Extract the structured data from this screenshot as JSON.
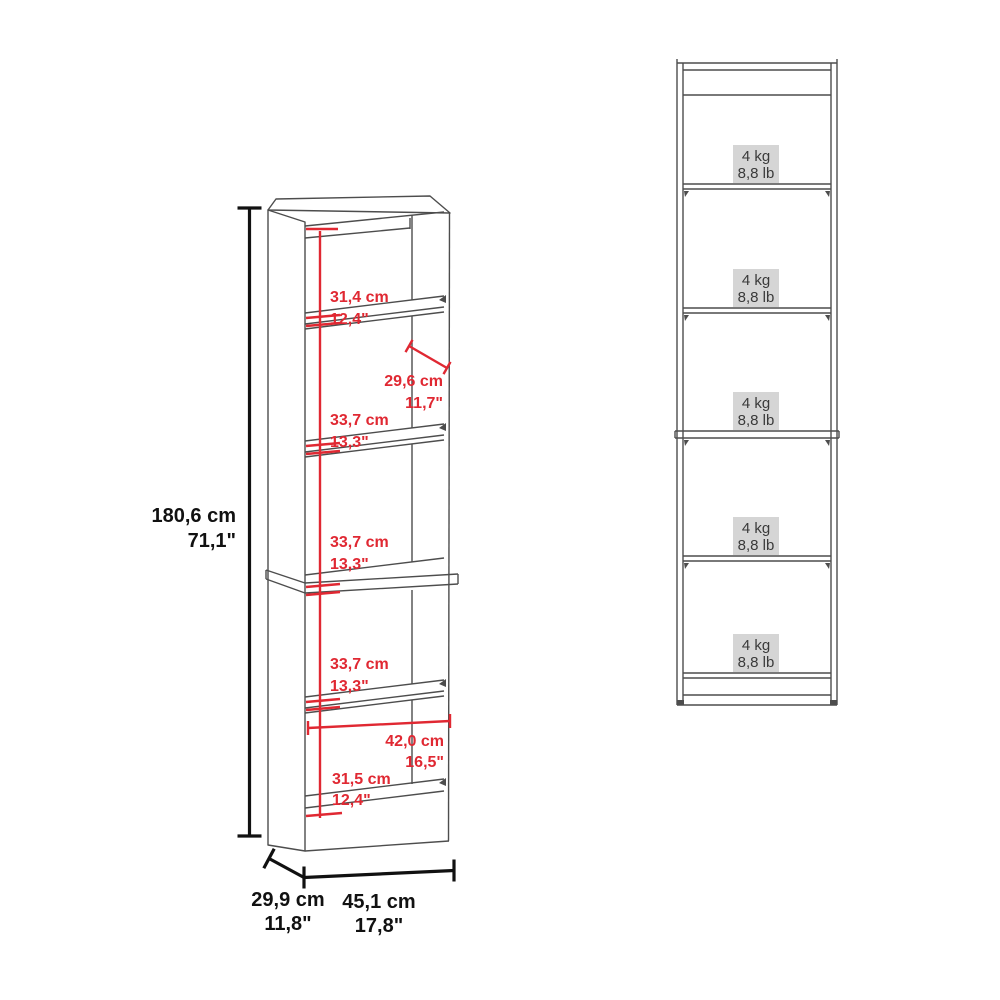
{
  "diagram": {
    "perspective_view": {
      "overall_height_cm": "180,6 cm",
      "overall_height_in": "71,1\"",
      "overall_depth_cm": "29,9 cm",
      "overall_depth_in": "11,8\"",
      "overall_width_cm": "45,1 cm",
      "overall_width_in": "17,8\"",
      "sections": [
        {
          "cm": "31,4 cm",
          "in": "12,4\""
        },
        {
          "cm": "29,6 cm",
          "in": "11,7\""
        },
        {
          "cm": "33,7 cm",
          "in": "13,3\""
        },
        {
          "cm": "33,7 cm",
          "in": "13,3\""
        },
        {
          "cm": "33,7 cm",
          "in": "13,3\""
        },
        {
          "cm": "42,0 cm",
          "in": "16,5\""
        },
        {
          "cm": "31,5 cm",
          "in": "12,4\""
        }
      ]
    },
    "front_view": {
      "shelf_count": 5,
      "shelf_capacity_kg": "4 kg",
      "shelf_capacity_lb": "8,8 lb"
    },
    "colors": {
      "dimension_red": "#e02832",
      "dimension_black": "#111111",
      "line_gray": "#4d4d4d",
      "capacity_chip_bg": "#d5d5d5",
      "capacity_chip_text": "#3a3a3a"
    }
  }
}
